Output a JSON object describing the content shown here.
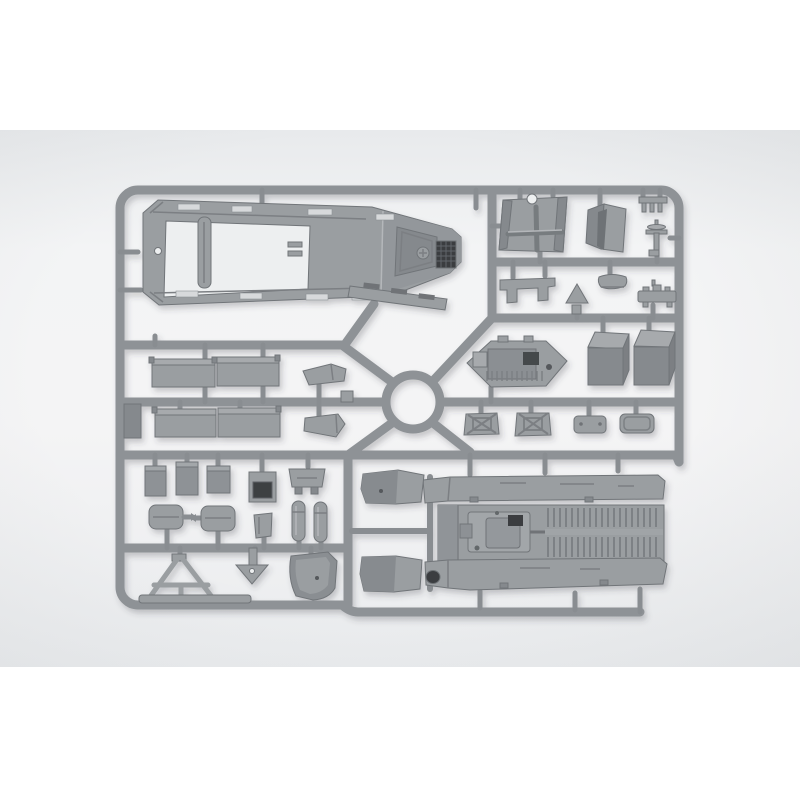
{
  "meta": {
    "scene": "Product photograph of an unassembled gray injection-molded plastic model-kit sprue (parts frame) for an armored half-track vehicle, lying on a light neutral background with white margins above and below the photo"
  },
  "colors": {
    "bg_page": "#ffffff",
    "bg_top": "#e8eaec",
    "bg_mid": "#f3f4f5",
    "bg_mid2": "#f4f4f5",
    "bg_bottom": "#eaecee",
    "runner": "#8e9296",
    "gate": "#898d91",
    "plastic_top": "#a7aaad",
    "plastic_mid": "#9a9ea1",
    "plastic_side": "#85898d",
    "plastic_dark": "#6e7276",
    "hole_dark": "#3b3e41",
    "bg_hole": "#edeff0",
    "slot_light": "#d7d9db",
    "edge": "#717579",
    "detail_line": "#7b7f83",
    "highlight": "#b4b7ba",
    "shadow": "#3c4044"
  },
  "parts": {
    "frame": {
      "label": "sprue runner frame with central ring"
    },
    "hull_roof": {
      "label": "large hull roof part with open interior, slots and engine grille"
    },
    "door_strip": {
      "label": "narrow door panel strip molded inside hull opening"
    },
    "slotted_step": {
      "label": "slotted step strip below hull nose"
    },
    "gun_shield": {
      "label": "gun shield plate with cross brace and top notch"
    },
    "folded_shield": {
      "label": "folded shield part in three-quarter view"
    },
    "fork_bracket": {
      "label": "small three-tine fork bracket"
    },
    "pedestal": {
      "label": "small pedestal mount with disc top"
    },
    "arch_seat": {
      "label": "arched bracket part"
    },
    "triangle_part": {
      "label": "solid triangular part"
    },
    "seat_pan": {
      "label": "shallow seat pan part"
    },
    "stud_bar": {
      "label": "small bar part with studs"
    },
    "engine_block": {
      "label": "hexagonal engine-deck part with recesses"
    },
    "fuel_tanks": {
      "label": "two rectangular box parts"
    },
    "hatches": {
      "label": "four small hatch and plate parts"
    },
    "benches": {
      "label": "four long bench-seat panels"
    },
    "mudflaps": {
      "label": "two small polygonal mud-flap parts"
    },
    "rail_strip": {
      "label": "small dark strip on left rail"
    },
    "stowage_row": {
      "label": "row of small stowage boxes and bracket"
    },
    "cushion_row": {
      "label": "seat cushions, seat back and two cylinder parts"
    },
    "antenna_frame": {
      "label": "A-frame antenna mount with base bar"
    },
    "funnel_part": {
      "label": "funnel-shaped part with hole"
    },
    "fender_bucket": {
      "label": "curved bucket fender part"
    },
    "floor_assembly": {
      "label": "hull floor with treadplate ribs, transmission, side skirts and fender wedges"
    }
  }
}
